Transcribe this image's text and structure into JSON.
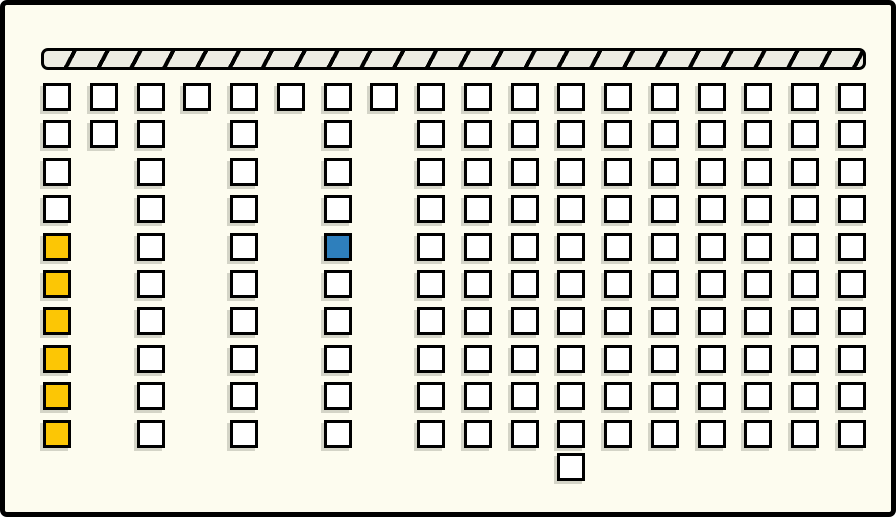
{
  "scene": {
    "description": "Grid diagram of outlined square tiles below a diagonally hatched horizontal bar",
    "background_color": "#fdfcef",
    "outline_color": "#000000"
  },
  "hatched_bar": {
    "x": 36,
    "y": 43,
    "width": 825,
    "height": 22,
    "fill": "#edece3",
    "stripe_color": "#000000"
  },
  "grid": {
    "origin_x": 38,
    "origin_y": 78,
    "col_spacing": 46.76,
    "row_spacing": 37.4,
    "cell_size": 28,
    "default_fill": "#ffffff",
    "highlight_yellow": "#fcc605",
    "highlight_blue": "#2e7fbc",
    "columns": [
      {
        "id": 1,
        "rows": [
          1,
          2,
          3,
          4,
          5,
          6,
          7,
          8,
          9,
          10
        ],
        "colors": {
          "5": "#fcc605",
          "6": "#fcc605",
          "7": "#fcc605",
          "8": "#fcc605",
          "9": "#fcc605",
          "10": "#fcc605"
        }
      },
      {
        "id": 2,
        "rows": [
          1,
          2
        ]
      },
      {
        "id": 3,
        "rows": [
          1,
          2,
          3,
          4,
          5,
          6,
          7,
          8,
          9,
          10
        ]
      },
      {
        "id": 4,
        "rows": [
          1
        ]
      },
      {
        "id": 5,
        "rows": [
          1,
          2,
          3,
          4,
          5,
          6,
          7,
          8,
          9,
          10
        ]
      },
      {
        "id": 6,
        "rows": [
          1
        ]
      },
      {
        "id": 7,
        "rows": [
          1,
          2,
          3,
          4,
          5,
          6,
          7,
          8,
          9,
          10
        ],
        "colors": {
          "5": "#2e7fbc"
        }
      },
      {
        "id": 8,
        "rows": [
          1
        ]
      },
      {
        "id": 9,
        "rows": [
          1,
          2,
          3,
          4,
          5,
          6,
          7,
          8,
          9,
          10
        ]
      },
      {
        "id": 10,
        "rows": [
          1,
          2,
          3,
          4,
          5,
          6,
          7,
          8,
          9,
          10
        ]
      },
      {
        "id": 11,
        "rows": [
          1,
          2,
          3,
          4,
          5,
          6,
          7,
          8,
          9,
          10
        ]
      },
      {
        "id": 12,
        "rows": [
          1,
          2,
          3,
          4,
          5,
          6,
          7,
          8,
          9,
          10
        ]
      },
      {
        "id": 13,
        "rows": [
          1,
          2,
          3,
          4,
          5,
          6,
          7,
          8,
          9,
          10
        ]
      },
      {
        "id": 14,
        "rows": [
          1,
          2,
          3,
          4,
          5,
          6,
          7,
          8,
          9,
          10
        ]
      },
      {
        "id": 15,
        "rows": [
          1,
          2,
          3,
          4,
          5,
          6,
          7,
          8,
          9,
          10
        ]
      },
      {
        "id": 16,
        "rows": [
          1,
          2,
          3,
          4,
          5,
          6,
          7,
          8,
          9,
          10
        ]
      },
      {
        "id": 17,
        "rows": [
          1,
          2,
          3,
          4,
          5,
          6,
          7,
          8,
          9,
          10
        ]
      },
      {
        "id": 18,
        "rows": [
          1,
          2,
          3,
          4,
          5,
          6,
          7,
          8,
          9,
          10
        ]
      }
    ],
    "extra_cell": {
      "col": 12,
      "row": 11,
      "y": 448,
      "fill": "#ffffff"
    }
  }
}
